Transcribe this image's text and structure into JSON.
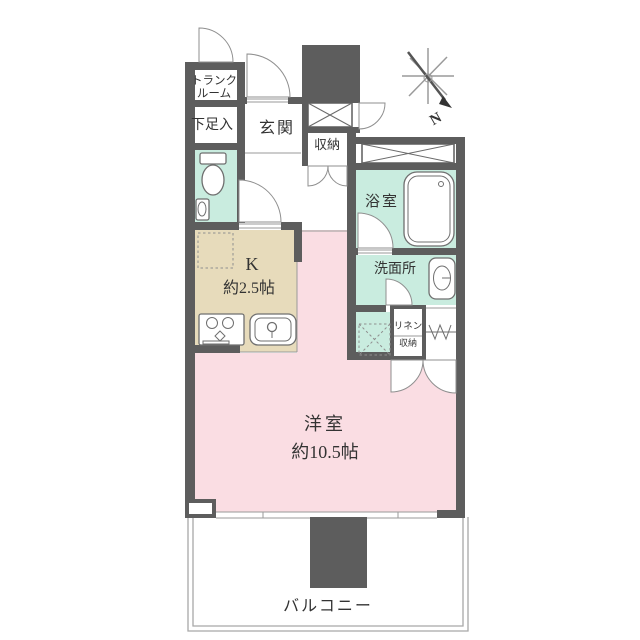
{
  "floorplan": {
    "rooms": {
      "trunk": {
        "line1": "トランク",
        "line2": "ルーム"
      },
      "shoe_storage": {
        "label": "下足入"
      },
      "entrance": {
        "label": "玄関"
      },
      "hall_closet": {
        "label": "収納"
      },
      "bathroom": {
        "label": "浴室"
      },
      "washroom": {
        "label": "洗面所"
      },
      "linen": {
        "line1": "リネン",
        "line2": "収納"
      },
      "kitchen": {
        "label": "K",
        "size": "約2.5帖"
      },
      "western_room": {
        "label": "洋室",
        "size": "約10.5帖"
      },
      "balcony": {
        "label": "バルコニー"
      }
    },
    "compass": {
      "label": "N"
    },
    "colors": {
      "wall": "#5d5d5d",
      "pink": "#fadde3",
      "mint": "#c9ecdf",
      "tan": "#e7dbbb",
      "line": "#8a8a8a",
      "text": "#333333"
    }
  }
}
